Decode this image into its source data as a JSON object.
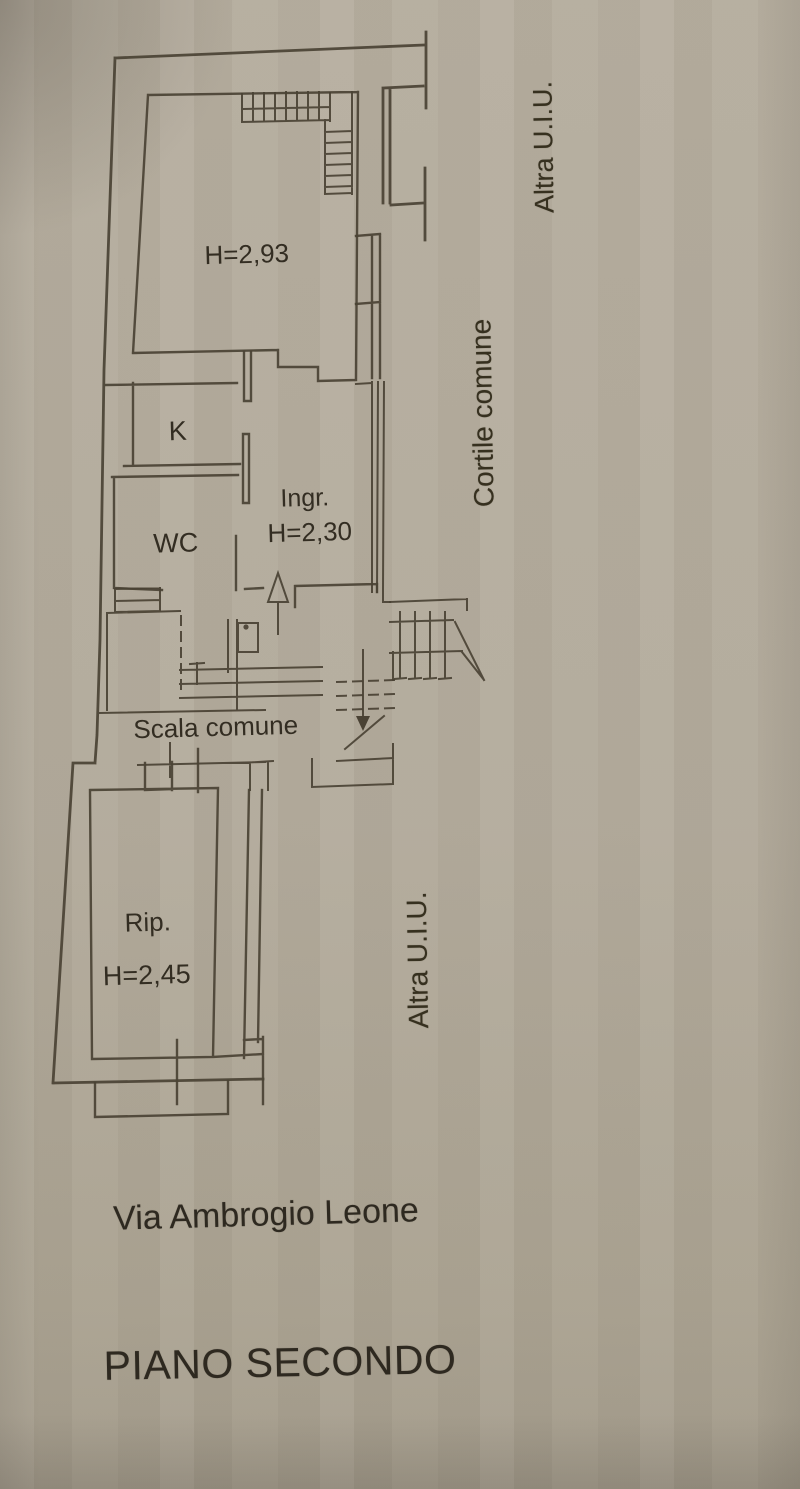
{
  "page": {
    "paper_color": "#b3ab9c",
    "ink_color": "#4a4234",
    "text_color": "#332d22"
  },
  "plan": {
    "labels": {
      "main_room_height": "H=2,93",
      "kitchen": "K",
      "wc": "WC",
      "entrance": "Ingr.",
      "entrance_height": "H=2,30",
      "common_staircase": "Scala comune",
      "storage": "Rip.",
      "storage_height": "H=2,45"
    },
    "margin_labels": {
      "other_unit_top": "Altra U.I.U.",
      "courtyard": "Cortile comune",
      "other_unit_bottom": "Altra U.I.U."
    }
  },
  "captions": {
    "street_name": "Via Ambrogio Leone",
    "floor_title": "PIANO SECONDO"
  }
}
